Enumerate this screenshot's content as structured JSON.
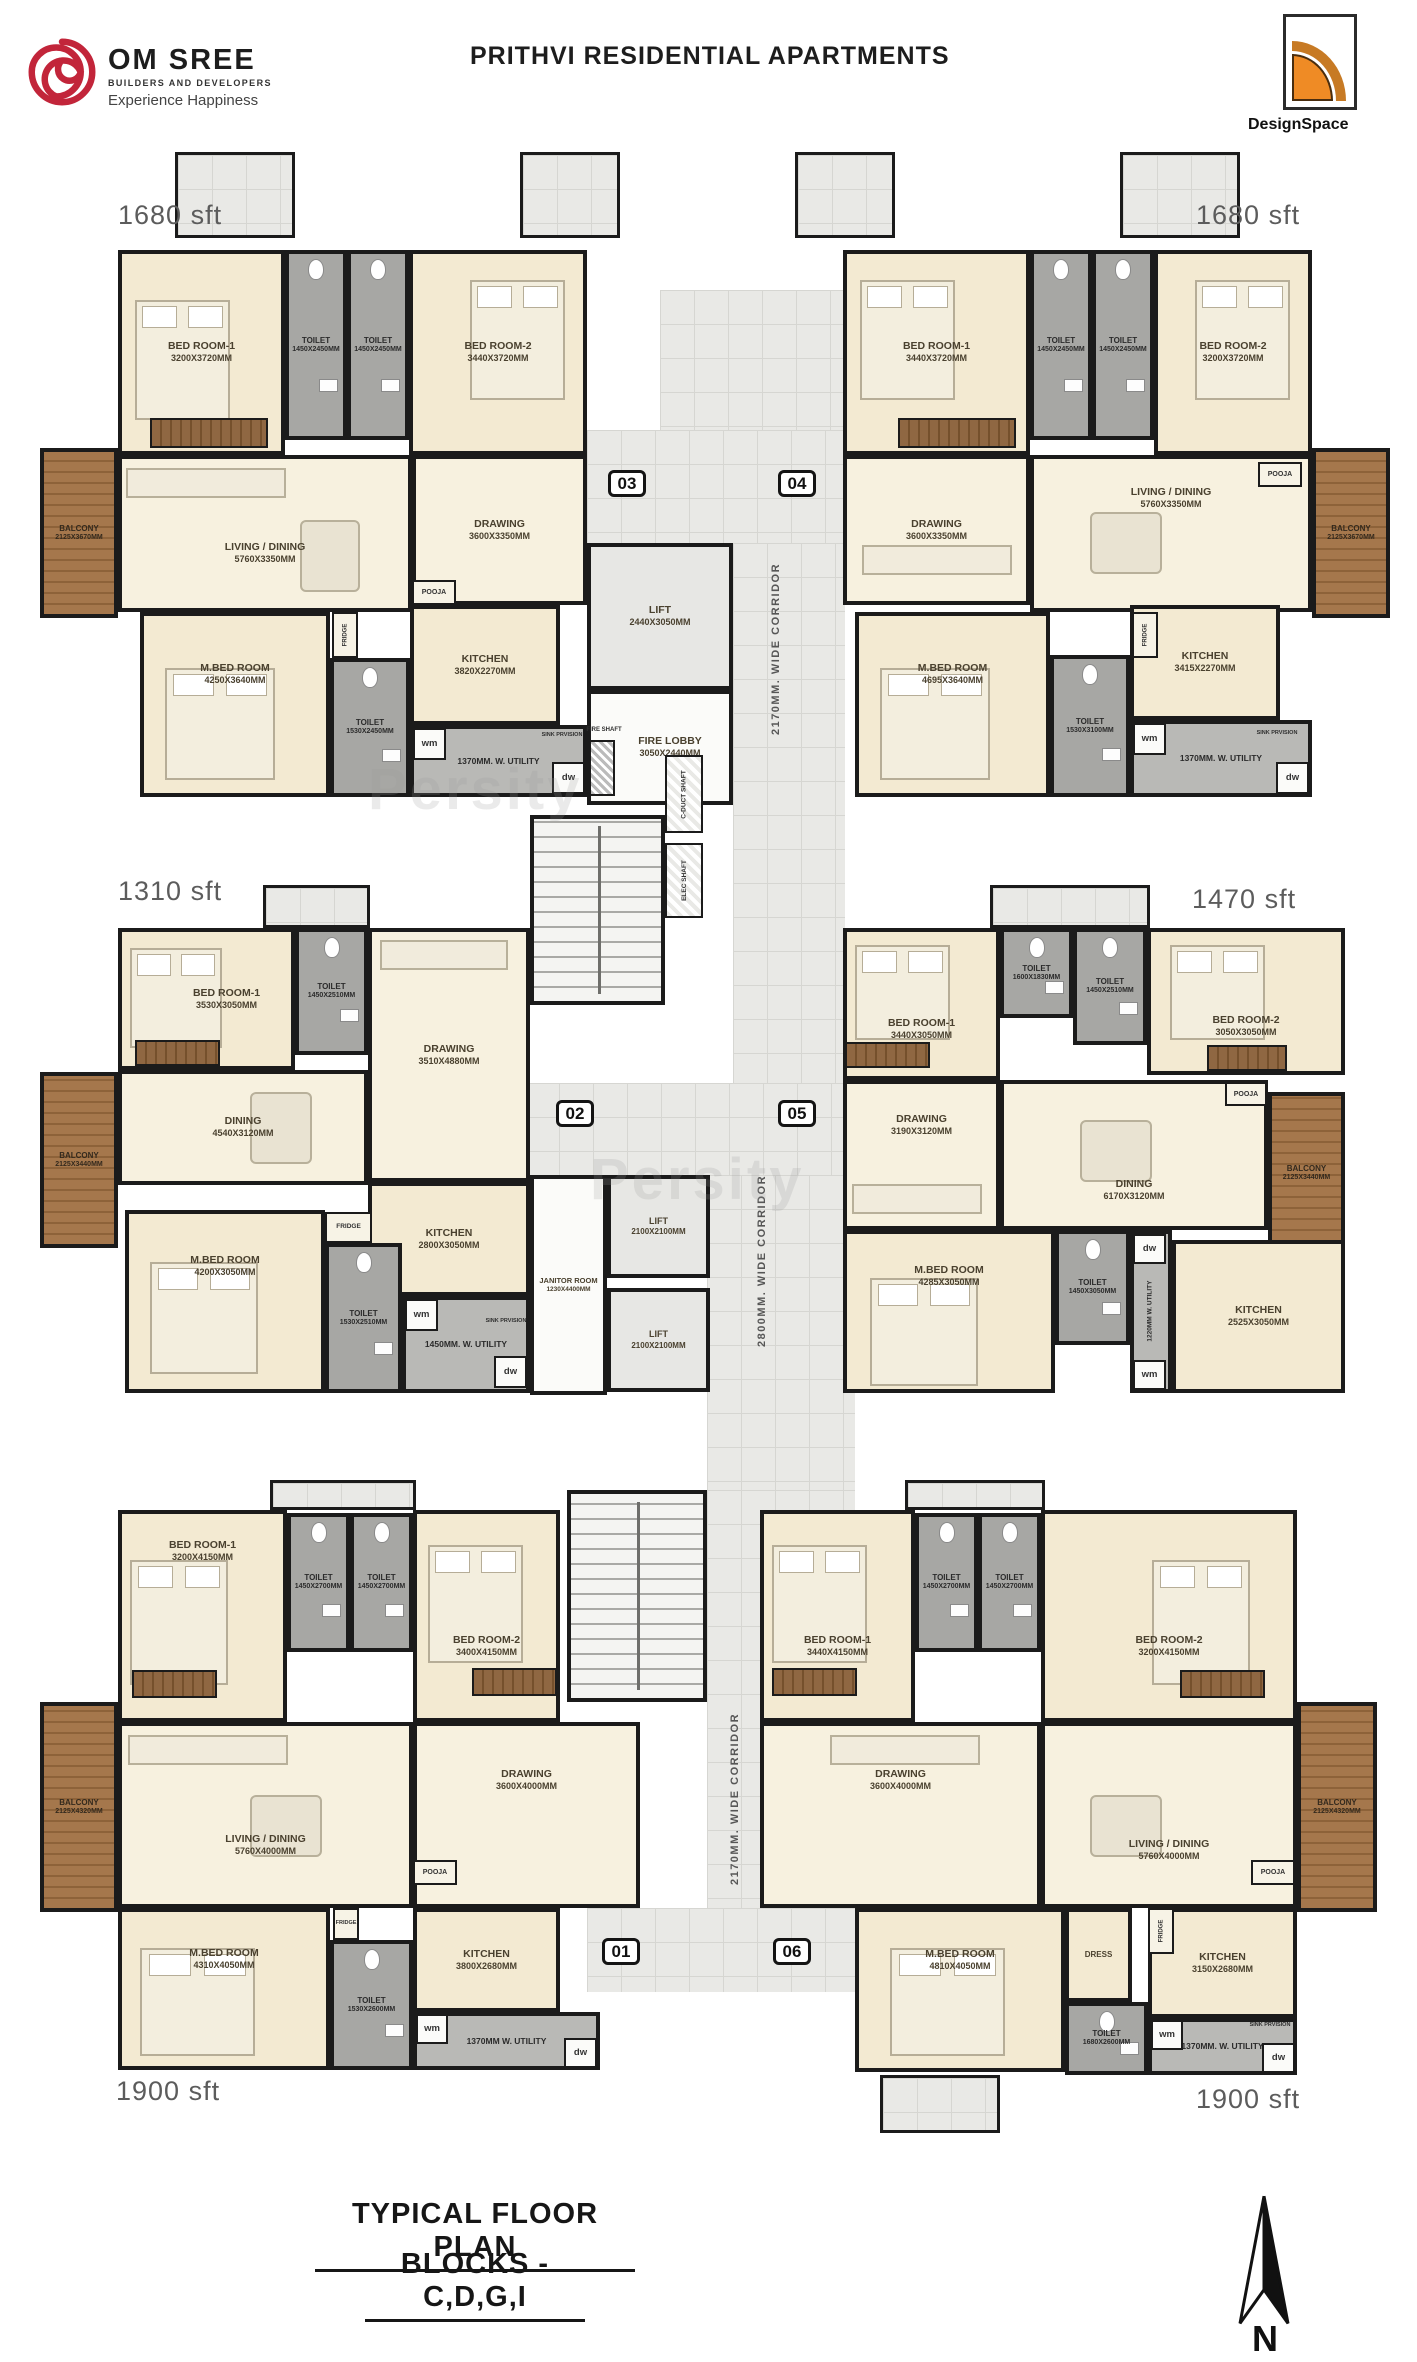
{
  "header": {
    "brand_name": "OM SREE",
    "brand_sub": "BUILDERS AND DEVELOPERS",
    "brand_tagline": "Experience Happiness",
    "title": "PRITHVI RESIDENTIAL APARTMENTS",
    "designer_logo": "DesignSpace"
  },
  "watermark": "Persity",
  "core": {
    "plate_03": "03",
    "plate_04": "04",
    "plate_02": "02",
    "plate_05": "05",
    "plate_01": "01",
    "plate_06": "06",
    "lift_top": {
      "name": "LIFT",
      "dims": "2440X3050MM"
    },
    "fire_lobby": {
      "name": "FIRE LOBBY",
      "dims": "3050X2440MM"
    },
    "fire_shaft": "FIRE SHAFT",
    "corridor_top": "2170MM. WIDE CORRIDOR",
    "corridor_mid": "2800MM. WIDE CORRIDOR",
    "corridor_bottom": "2170MM. WIDE CORRIDOR",
    "duct_shaft": "C-DUCT SHAFT",
    "elec_shaft": "ELEC SHAFT",
    "janitor": {
      "name": "JANITOR ROOM",
      "dims": "1230X4400MM"
    },
    "lift_mid_1": {
      "name": "LIFT",
      "dims": "2100X2100MM"
    },
    "lift_mid_2": {
      "name": "LIFT",
      "dims": "2100X2100MM"
    }
  },
  "units": {
    "u03": {
      "area": "1680 sft",
      "bed1": {
        "name": "BED ROOM-1",
        "dims": "3200X3720MM"
      },
      "toilet_a": {
        "name": "TOILET",
        "dims": "1450X2450MM"
      },
      "toilet_b": {
        "name": "TOILET",
        "dims": "1450X2450MM"
      },
      "bed2": {
        "name": "BED ROOM-2",
        "dims": "3440X3720MM"
      },
      "living": {
        "name": "LIVING / DINING",
        "dims": "5760X3350MM"
      },
      "drawing": {
        "name": "DRAWING",
        "dims": "3600X3350MM"
      },
      "balcony": {
        "name": "BALCONY",
        "dims": "2125X3670MM"
      },
      "mbed": {
        "name": "M.BED ROOM",
        "dims": "4250X3640MM"
      },
      "toilet_m": {
        "name": "TOILET",
        "dims": "1530X2450MM"
      },
      "kitchen": {
        "name": "KITCHEN",
        "dims": "3820X2270MM"
      },
      "pooja": "POOJA",
      "fridge": "FRIDGE",
      "utility": "1370MM. W. UTILITY",
      "wm": "wm",
      "dw": "dw",
      "sink": "SINK PRVISION"
    },
    "u04": {
      "area": "1680 sft",
      "bed1": {
        "name": "BED ROOM-1",
        "dims": "3440X3720MM"
      },
      "toilet_a": {
        "name": "TOILET",
        "dims": "1450X2450MM"
      },
      "toilet_b": {
        "name": "TOILET",
        "dims": "1450X2450MM"
      },
      "bed2": {
        "name": "BED ROOM-2",
        "dims": "3200X3720MM"
      },
      "drawing": {
        "name": "DRAWING",
        "dims": "3600X3350MM"
      },
      "living": {
        "name": "LIVING / DINING",
        "dims": "5760X3350MM"
      },
      "balcony": {
        "name": "BALCONY",
        "dims": "2125X3670MM"
      },
      "mbed": {
        "name": "M.BED ROOM",
        "dims": "4695X3640MM"
      },
      "toilet_m": {
        "name": "TOILET",
        "dims": "1530X3100MM"
      },
      "kitchen": {
        "name": "KITCHEN",
        "dims": "3415X2270MM"
      },
      "pooja": "POOJA",
      "fridge": "FRIDGE",
      "utility": "1370MM. W. UTILITY",
      "wm": "wm",
      "dw": "dw",
      "sink": "SINK PRVISION"
    },
    "u02": {
      "area": "1310 sft",
      "bed1": {
        "name": "BED ROOM-1",
        "dims": "3530X3050MM"
      },
      "toilet_a": {
        "name": "TOILET",
        "dims": "1450X2510MM"
      },
      "drawing": {
        "name": "DRAWING",
        "dims": "3510X4880MM"
      },
      "dining": {
        "name": "DINING",
        "dims": "4540X3120MM"
      },
      "balcony": {
        "name": "BALCONY",
        "dims": "2125X3440MM"
      },
      "kitchen": {
        "name": "KITCHEN",
        "dims": "2800X3050MM"
      },
      "mbed": {
        "name": "M.BED ROOM",
        "dims": "4200X3050MM"
      },
      "toilet_m": {
        "name": "TOILET",
        "dims": "1530X2510MM"
      },
      "fridge": "FRIDGE",
      "utility": "1450MM. W. UTILITY",
      "wm": "wm",
      "dw": "dw",
      "sink": "SINK PRVISION"
    },
    "u05": {
      "area": "1470 sft",
      "bed1": {
        "name": "BED ROOM-1",
        "dims": "3440X3050MM"
      },
      "toilet_a": {
        "name": "TOILET",
        "dims": "1600X1830MM"
      },
      "toilet_b": {
        "name": "TOILET",
        "dims": "1450X2510MM"
      },
      "bed2": {
        "name": "BED ROOM-2",
        "dims": "3050X3050MM"
      },
      "drawing": {
        "name": "DRAWING",
        "dims": "3190X3120MM"
      },
      "dining": {
        "name": "DINING",
        "dims": "6170X3120MM"
      },
      "pooja": "POOJA",
      "balcony": {
        "name": "BALCONY",
        "dims": "2125X3440MM"
      },
      "mbed": {
        "name": "M.BED ROOM",
        "dims": "4285X3050MM"
      },
      "toilet_m": {
        "name": "TOILET",
        "dims": "1450X3050MM"
      },
      "kitchen": {
        "name": "KITCHEN",
        "dims": "2525X3050MM"
      },
      "utility": "1220MM W. UTILITY",
      "wm": "wm",
      "dw": "dw"
    },
    "u01": {
      "area": "1900 sft",
      "bed1": {
        "name": "BED ROOM-1",
        "dims": "3200X4150MM"
      },
      "toilet_a": {
        "name": "TOILET",
        "dims": "1450X2700MM"
      },
      "toilet_b": {
        "name": "TOILET",
        "dims": "1450X2700MM"
      },
      "bed2": {
        "name": "BED ROOM-2",
        "dims": "3400X4150MM"
      },
      "living": {
        "name": "LIVING / DINING",
        "dims": "5760X4000MM"
      },
      "drawing": {
        "name": "DRAWING",
        "dims": "3600X4000MM"
      },
      "pooja": "POOJA",
      "balcony": {
        "name": "BALCONY",
        "dims": "2125X4320MM"
      },
      "mbed": {
        "name": "M.BED ROOM",
        "dims": "4310X4050MM"
      },
      "toilet_m": {
        "name": "TOILET",
        "dims": "1530X2600MM"
      },
      "kitchen": {
        "name": "KITCHEN",
        "dims": "3800X2680MM"
      },
      "fridge": "FRIDGE",
      "utility": "1370MM W. UTILITY",
      "wm": "wm",
      "dw": "dw"
    },
    "u06": {
      "area": "1900 sft",
      "bed1": {
        "name": "BED ROOM-1",
        "dims": "3440X4150MM"
      },
      "toilet_a": {
        "name": "TOILET",
        "dims": "1450X2700MM"
      },
      "toilet_b": {
        "name": "TOILET",
        "dims": "1450X2700MM"
      },
      "bed2": {
        "name": "BED ROOM-2",
        "dims": "3200X4150MM"
      },
      "drawing": {
        "name": "DRAWING",
        "dims": "3600X4000MM"
      },
      "living": {
        "name": "LIVING / DINING",
        "dims": "5760X4000MM"
      },
      "pooja": "POOJA",
      "balcony": {
        "name": "BALCONY",
        "dims": "2125X4320MM"
      },
      "mbed": {
        "name": "M.BED ROOM",
        "dims": "4810X4050MM"
      },
      "dress": "DRESS",
      "toilet_m": {
        "name": "TOILET",
        "dims": "1680X2600MM"
      },
      "kitchen": {
        "name": "KITCHEN",
        "dims": "3150X2680MM"
      },
      "fridge": "FRIDGE",
      "utility": "1370MM. W. UTILITY",
      "wm": "wm",
      "dw": "dw",
      "sink": "SINK PRVISION"
    }
  },
  "footer": {
    "line1": "TYPICAL FLOOR PLAN",
    "line2": "BLOCKS - C,D,G,I",
    "north": "N"
  }
}
